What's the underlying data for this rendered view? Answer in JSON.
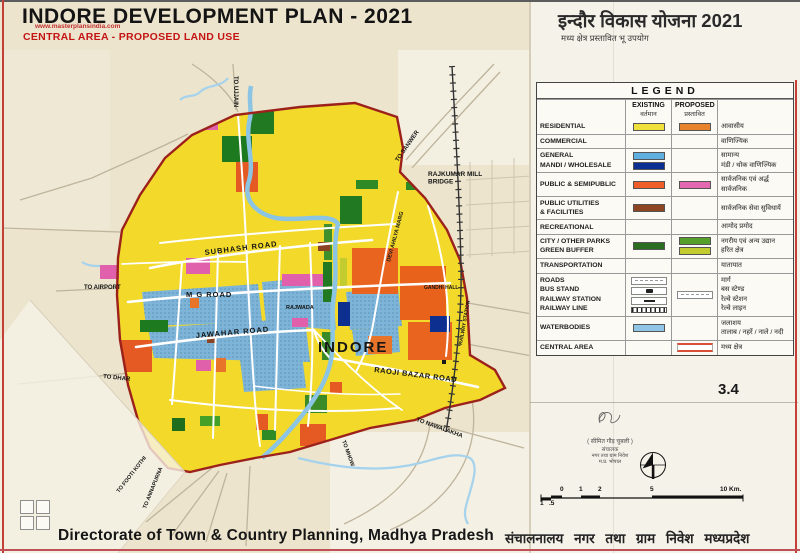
{
  "page": {
    "page_number": "3.4"
  },
  "header": {
    "title_en": "INDORE DEVELOPMENT PLAN - 2021",
    "watermark": "www.masterplansindia.com",
    "subtitle_en": "CENTRAL AREA - PROPOSED LAND USE",
    "title_hi": "इन्दौर विकास योजना 2021",
    "subtitle_hi": "मध्य क्षेत्र प्रस्तावित भू उपयोग"
  },
  "legend": {
    "title": "LEGEND",
    "col_existing_en": "EXISTING",
    "col_existing_hi": "वर्तमान",
    "col_proposed_en": "PROPOSED",
    "col_proposed_hi": "प्रस्तावित",
    "rows": [
      {
        "label_en": "RESIDENTIAL",
        "existing": [
          "#f0e03c"
        ],
        "proposed": [
          "#e8832c"
        ],
        "label_hi": "आवासीय"
      },
      {
        "label_en": "COMMERCIAL",
        "label_hi": "वाणिज्यिक"
      },
      {
        "label_en": "GENERAL\nMANDI / WHOLESALE",
        "existing": [
          "#5fb0e0",
          "#0b3092"
        ],
        "label_hi": "सामान्य\nमंडी / थोक वाणिज्यिक"
      },
      {
        "label_en": "PUBLIC & SEMIPUBLIC",
        "existing": [
          "#ef5e28"
        ],
        "proposed": [
          "#e468b0"
        ],
        "label_hi": "सार्वजनिक एवं अर्द्ध सार्वजनिक"
      },
      {
        "label_en": "PUBLIC UTILITIES\n& FACILITIES",
        "existing": [
          "#8e4522"
        ],
        "label_hi": "सार्वजनिक सेवा सुविधायें"
      },
      {
        "label_en": "RECREATIONAL",
        "label_hi": "आमोद प्रमोद"
      },
      {
        "label_en": "CITY / OTHER PARKS\nGREEN BUFFER",
        "existing": [
          "#2c6e1f"
        ],
        "proposed": [
          "#55a02a",
          "#c2cc2e"
        ],
        "label_hi": "नगरीय एवं अन्य उद्यान\nहरित क्षेत्र"
      },
      {
        "label_en": "TRANSPORTATION",
        "label_hi": "यातायात"
      },
      {
        "label_en": "ROADS\nBUS STAND\nRAILWAY STATION\nRAILWAY LINE",
        "existing_symbols": [
          "road",
          "bus-stand",
          "railway-station",
          "railway-line"
        ],
        "proposed_symbols": [
          "road"
        ],
        "label_hi": "मार्ग\nबस स्टेण्ड\nरेल्वे स्टेशन\nरेल्वे लाइन"
      },
      {
        "label_en": "WATERBODIES",
        "existing": [
          "#8fc6e6"
        ],
        "label_hi": "जलाशय\nतालाब / नहरें / नाले / नदी"
      },
      {
        "label_en": "CENTRAL AREA",
        "proposed_symbols": [
          "central-area"
        ],
        "label_hi": "मध्य क्षेत्र"
      }
    ]
  },
  "map": {
    "labels": [
      {
        "id": "to-ujjain",
        "text": "TO UJJAIN",
        "x": 234,
        "y": 76,
        "rot": 90,
        "size": 6
      },
      {
        "id": "to-sanwer",
        "text": "TO SANWER",
        "x": 398,
        "y": 162,
        "rot": -55,
        "size": 6
      },
      {
        "id": "rajkumar-mill-bridge",
        "lines": [
          "RAJKUMAR MILL",
          "BRIDGE"
        ],
        "x": 428,
        "y": 176,
        "size": 6.5
      },
      {
        "id": "subhash-road",
        "text": "SUBHASH ROAD",
        "x": 205,
        "y": 255,
        "rot": -7,
        "size": 7.5,
        "spacing": 1
      },
      {
        "id": "devi-ahilya-marg",
        "text": "DEVI AHILYA MARG",
        "x": 390,
        "y": 262,
        "rot": -75,
        "size": 5.5
      },
      {
        "id": "mg-road",
        "text": "M G ROAD",
        "x": 186,
        "y": 297,
        "size": 7.5,
        "spacing": 1
      },
      {
        "id": "rajwada",
        "text": "RAJWADA",
        "x": 286,
        "y": 309,
        "size": 5.5
      },
      {
        "id": "gandhi-hall",
        "text": "GANDHI HALL",
        "x": 424,
        "y": 289,
        "size": 5
      },
      {
        "id": "railway-station",
        "text": "RAILWAY STATION",
        "x": 462,
        "y": 345,
        "rot": -80,
        "size": 5
      },
      {
        "id": "jawahar-road",
        "text": "JAWAHAR ROAD",
        "x": 196,
        "y": 338,
        "rot": -5,
        "size": 7.5,
        "spacing": 1
      },
      {
        "id": "indore",
        "text": "INDORE",
        "x": 318,
        "y": 352,
        "size": 15,
        "weight": 800,
        "spacing": 2
      },
      {
        "id": "raoji-bazar-road",
        "text": "RAOJI BAZAR ROAD",
        "x": 374,
        "y": 372,
        "rot": 7,
        "size": 7.5,
        "spacing": 0.5
      },
      {
        "id": "to-airport",
        "text": "TO AIRPORT",
        "x": 84,
        "y": 289,
        "size": 6
      },
      {
        "id": "to-dhar",
        "text": "TO DHAR",
        "x": 103,
        "y": 378,
        "rot": 6,
        "size": 6
      },
      {
        "id": "to-footi-kothi",
        "text": "TO FOOTI KOTHI",
        "x": 119,
        "y": 493,
        "rot": -52,
        "size": 5.5
      },
      {
        "id": "to-annapurna",
        "text": "TO ANNAPURNA",
        "x": 146,
        "y": 509,
        "rot": -68,
        "size": 5.5
      },
      {
        "id": "to-mhow",
        "text": "TO MHOW",
        "x": 342,
        "y": 441,
        "rot": 70,
        "size": 5.5
      },
      {
        "id": "to-nawalakha",
        "text": "TO NAWALAKHA",
        "x": 416,
        "y": 421,
        "rot": 20,
        "size": 6
      }
    ]
  },
  "stamp": {
    "name": "( सीमित गौड़ चुबली )",
    "line1": "संचालक",
    "line2": "नगर तथा ग्राम निवेश",
    "line3": "म.प्र. भोपाल"
  },
  "scale_bar": {
    "labels": [
      {
        "t": "1",
        "x": 540,
        "below": true
      },
      {
        "t": ".5",
        "x": 549,
        "below": true
      },
      {
        "t": "0",
        "x": 560
      },
      {
        "t": "1",
        "x": 579
      },
      {
        "t": "2",
        "x": 598
      },
      {
        "t": "5",
        "x": 650
      },
      {
        "t": "10 Km.",
        "x": 720
      }
    ]
  },
  "footer": {
    "left_en": "Directorate of Town & Country Planning, Madhya Pradesh",
    "right_hi": "संचालनालय नगर तथा ग्राम निवेश मध्यप्रदेश"
  },
  "colors": {
    "plan_yellow": "#f2d92a",
    "boundary_red": "#9c211b",
    "commercial_blue": "#7db4d8",
    "water_blue": "#8cc4e4",
    "paper": "#ece4cd",
    "subtitle_red": "#c41414"
  }
}
